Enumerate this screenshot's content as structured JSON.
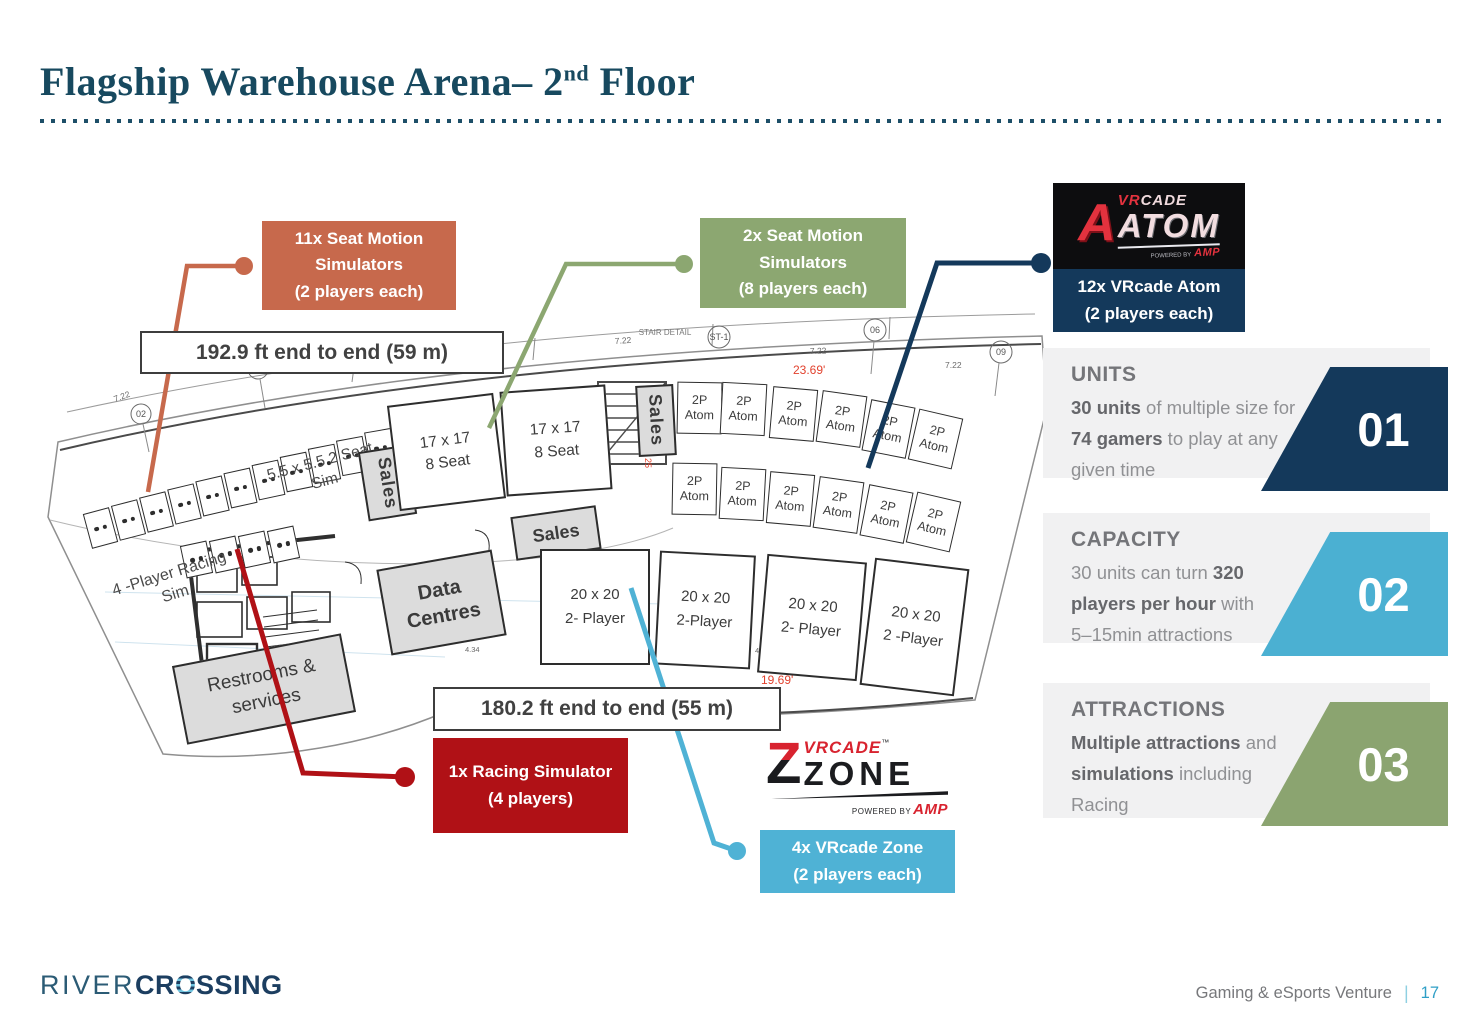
{
  "title": {
    "prefix": "Flagship Warehouse Arena– 2",
    "sup": "nd",
    "suffix": " Floor"
  },
  "colors": {
    "title_navy": "#17495F",
    "orange": "#C7694C",
    "green": "#8CA771",
    "navy": "#14395B",
    "red": "#B01116",
    "cyan": "#4FB2D5",
    "panel_gray": "#F1F1F2"
  },
  "callouts": {
    "seat_motion_11": {
      "line1": "11x Seat Motion",
      "line2": "Simulators",
      "line3": "(2 players each)"
    },
    "seat_motion_2": {
      "line1": "2x Seat Motion",
      "line2": "Simulators",
      "line3": "(8 players each)"
    },
    "vrcade_atom": {
      "line1": "12x VRcade Atom",
      "line2": "(2 players each)"
    },
    "racing": {
      "line1": "1x Racing Simulator",
      "line2": "(4 players)"
    },
    "vrcade_zone": {
      "line1": "4x VRcade Zone",
      "line2": "(2 players each)"
    }
  },
  "measurements": {
    "top": "192.9 ft end to end (59 m)",
    "bottom": "180.2 ft end to end (55 m)"
  },
  "plan": {
    "sales": "Sales",
    "seat17_l1": "17 x 17",
    "seat17_l2": "8 Seat",
    "atom_l1": "2P",
    "atom_l2": "Atom",
    "r20_l1": "20 x 20",
    "r20_sub_1": "2- Player",
    "r20_sub_2": "2-Player",
    "r20_sub_3": "2- Player",
    "r20_sub_4": "2 -Player",
    "sim55_l1": "5.5 x 5.5",
    "sim55_l2": "2 Seat Sim",
    "racing_l1": "4 -Player",
    "racing_l2": "Racing Sim",
    "data_l1": "Data",
    "data_l2": "Centres",
    "rest_l1": "Restrooms &",
    "rest_l2": "services",
    "stair_detail": "STAIR DETAIL",
    "st1": "ST-1",
    "down": "Down",
    "g02": "02",
    "g03": "03",
    "g06": "06",
    "g09": "09",
    "d722": "7.22",
    "d825": "8.25",
    "d434": "4.34",
    "d2369": "23.69'",
    "d1969": "19.69'",
    "d2559": "25.59",
    "d25": "25"
  },
  "logos": {
    "atom": {
      "a": "A",
      "vr": "VR",
      "cade": "CADE",
      "name": "ATOM",
      "powered": "POWERED BY",
      "amp": "AMP"
    },
    "zone": {
      "z": "Z",
      "vrcade": "VRCADE",
      "tm": "™",
      "name": "ZONE",
      "powered": "POWERED BY",
      "amp": "AMP"
    }
  },
  "panels": {
    "units": {
      "heading": "UNITS",
      "b1": "30 units",
      "r1": " of multiple size for",
      "b2": "74 gamers",
      "r2": " to play at any",
      "r3": "given time",
      "number": "01"
    },
    "capacity": {
      "heading": "CAPACITY",
      "r1": "30 units can turn ",
      "b1": "320",
      "b2": "players per hour",
      "r2": " with",
      "r3": "5–15min attractions",
      "number": "02"
    },
    "attractions": {
      "heading": "ATTRACTIONS",
      "b1": "Multiple attractions",
      "r1": " and",
      "b2": "simulations",
      "r2": " including",
      "r3": "Racing",
      "number": "03"
    }
  },
  "footer": {
    "brand_thin": "RIVER",
    "brand_bold_pre": "CR",
    "brand_o": "O",
    "brand_bold_post": "SSING",
    "tagline": "Gaming & eSports Venture",
    "divider": "|",
    "page": "17"
  }
}
